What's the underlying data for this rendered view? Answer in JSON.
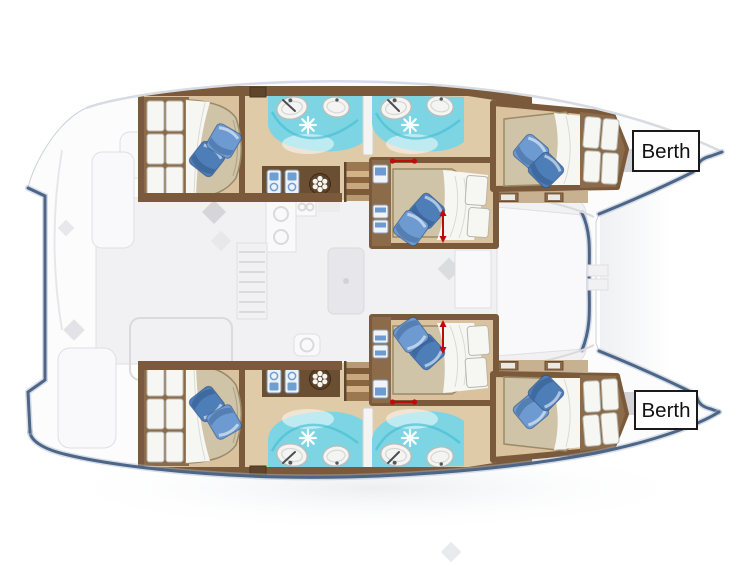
{
  "diagram": {
    "type": "catamaran-deck-plan",
    "description": "Top-view layout plan of a four-cabin sailing catamaran; cabins with double berths, bathrooms and companionway stairs are drawn in colour over a ghosted deck outline, bow pointing right",
    "annotations": [
      {
        "id": "berth-top",
        "label": "Berth"
      },
      {
        "id": "berth-bottom",
        "label": "Berth"
      }
    ]
  },
  "icons": {
    "shower": "snowflake-icon",
    "air_vent": "fan-icon",
    "toilet_unit": "washer-icon",
    "basin": "sink-icon",
    "berth_dimension": "red-arrow-icon",
    "pillow": "pillow-icon"
  },
  "colors": {
    "deck_white": "#fcfcfd",
    "hull_line": "#4d6587",
    "hull_line_soft": "#a9b8cc",
    "ghost_fill": "#f1f1f4",
    "ghost_line": "#dfdfe4",
    "wood_dark": "#7a5a3a",
    "wood_deep": "#5e452b",
    "wood_mid": "#8b6b49",
    "floor_tan": "#d9c29d",
    "floor_light": "#e0cba8",
    "mattress": "#cfc3a8",
    "mattress_edge": "#9a8a68",
    "sheet": "#f6f6f3",
    "pillow_blue": "#6d9bd1",
    "pillow_dark": "#4e7eb8",
    "bath_teal": "#7dd5e4",
    "teal_deep": "#45bdd2",
    "sink_white": "#f4f4f2",
    "arrow_red": "#c00b0b",
    "label_bg": "#ffffff",
    "label_border": "#1a1a1a",
    "label_text": "#111111"
  }
}
